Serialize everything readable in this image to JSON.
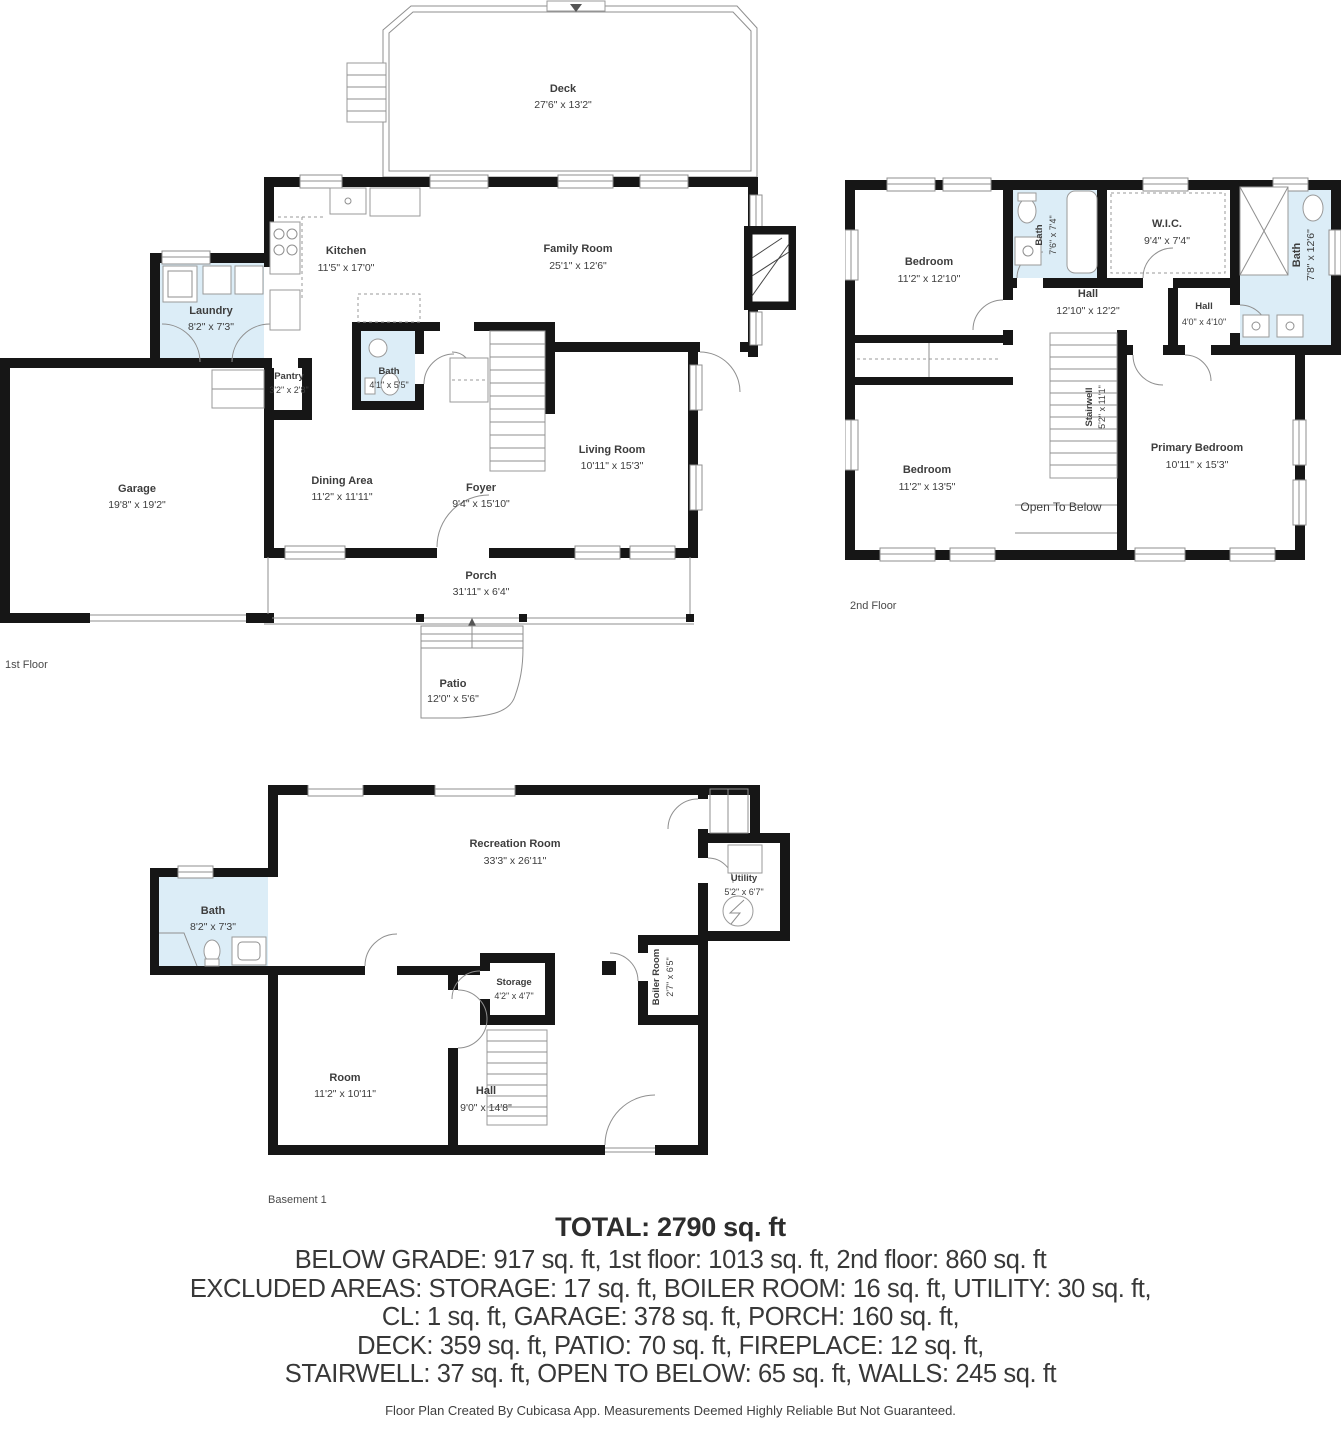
{
  "floors": {
    "first": {
      "label": "1st Floor",
      "rooms": {
        "deck": {
          "name": "Deck",
          "dims": "27'6\" x 13'2\""
        },
        "kitchen": {
          "name": "Kitchen",
          "dims": "11'5\" x 17'0\""
        },
        "family": {
          "name": "Family Room",
          "dims": "25'1\" x 12'6\""
        },
        "laundry": {
          "name": "Laundry",
          "dims": "8'2\" x 7'3\""
        },
        "pantry": {
          "name": "Pantry",
          "dims": "3'2\" x 2'8\""
        },
        "bath": {
          "name": "Bath",
          "dims": "4'1\" x 5'5\""
        },
        "garage": {
          "name": "Garage",
          "dims": "19'8\" x 19'2\""
        },
        "dining": {
          "name": "Dining Area",
          "dims": "11'2\" x 11'11\""
        },
        "foyer": {
          "name": "Foyer",
          "dims": "9'4\" x 15'10\""
        },
        "living": {
          "name": "Living Room",
          "dims": "10'11\" x 15'3\""
        },
        "porch": {
          "name": "Porch",
          "dims": "31'11\" x 6'4\""
        },
        "patio": {
          "name": "Patio",
          "dims": "12'0\" x 5'6\""
        }
      }
    },
    "second": {
      "label": "2nd Floor",
      "rooms": {
        "bedroom1": {
          "name": "Bedroom",
          "dims": "11'2\" x 12'10\""
        },
        "bath1": {
          "name": "Bath",
          "dims": "7'6\" x 7'4\""
        },
        "wic": {
          "name": "W.I.C.",
          "dims": "9'4\" x 7'4\""
        },
        "bath2": {
          "name": "Bath",
          "dims": "7'8\" x 12'6\""
        },
        "hall1": {
          "name": "Hall",
          "dims": "12'10\" x 12'2\""
        },
        "hall2": {
          "name": "Hall",
          "dims": "4'0\" x 4'10\""
        },
        "bedroom2": {
          "name": "Bedroom",
          "dims": "11'2\" x 13'5\""
        },
        "stairwell": {
          "name": "Stairwell",
          "dims": "5'2\" x 11'1\""
        },
        "open_below": {
          "name": "Open To Below"
        },
        "primary": {
          "name": "Primary Bedroom",
          "dims": "10'11\" x 15'3\""
        }
      }
    },
    "basement": {
      "label": "Basement 1",
      "rooms": {
        "rec": {
          "name": "Recreation Room",
          "dims": "33'3\" x 26'11\""
        },
        "bath": {
          "name": "Bath",
          "dims": "8'2\" x 7'3\""
        },
        "utility": {
          "name": "Utility",
          "dims": "5'2\" x 6'7\""
        },
        "storage": {
          "name": "Storage",
          "dims": "4'2\" x 4'7\""
        },
        "boiler": {
          "name": "Boiler Room",
          "dims": "2'7\" x 6'5\""
        },
        "room": {
          "name": "Room",
          "dims": "11'2\" x 10'11\""
        },
        "hall": {
          "name": "Hall",
          "dims": "9'0\" x 14'8\""
        }
      }
    }
  },
  "summary": {
    "total": "TOTAL: 2790 sq. ft",
    "lines": [
      "BELOW GRADE: 917 sq. ft, 1st floor: 1013 sq. ft, 2nd floor: 860 sq. ft",
      "EXCLUDED AREAS: STORAGE: 17 sq. ft, BOILER ROOM: 16 sq. ft, UTILITY: 30 sq. ft,",
      "CL: 1 sq. ft, GARAGE: 378 sq. ft, PORCH: 160 sq. ft,",
      "DECK: 359 sq. ft, PATIO: 70 sq. ft, FIREPLACE: 12 sq. ft,",
      "STAIRWELL: 37 sq. ft, OPEN TO BELOW: 65 sq. ft, WALLS: 245 sq. ft"
    ],
    "footer": "Floor Plan Created By Cubicasa App. Measurements Deemed Highly Reliable But Not Guaranteed."
  },
  "colors": {
    "wall": "#161616",
    "wet_room": "#dcedf7",
    "text": "#3d3d3d"
  }
}
